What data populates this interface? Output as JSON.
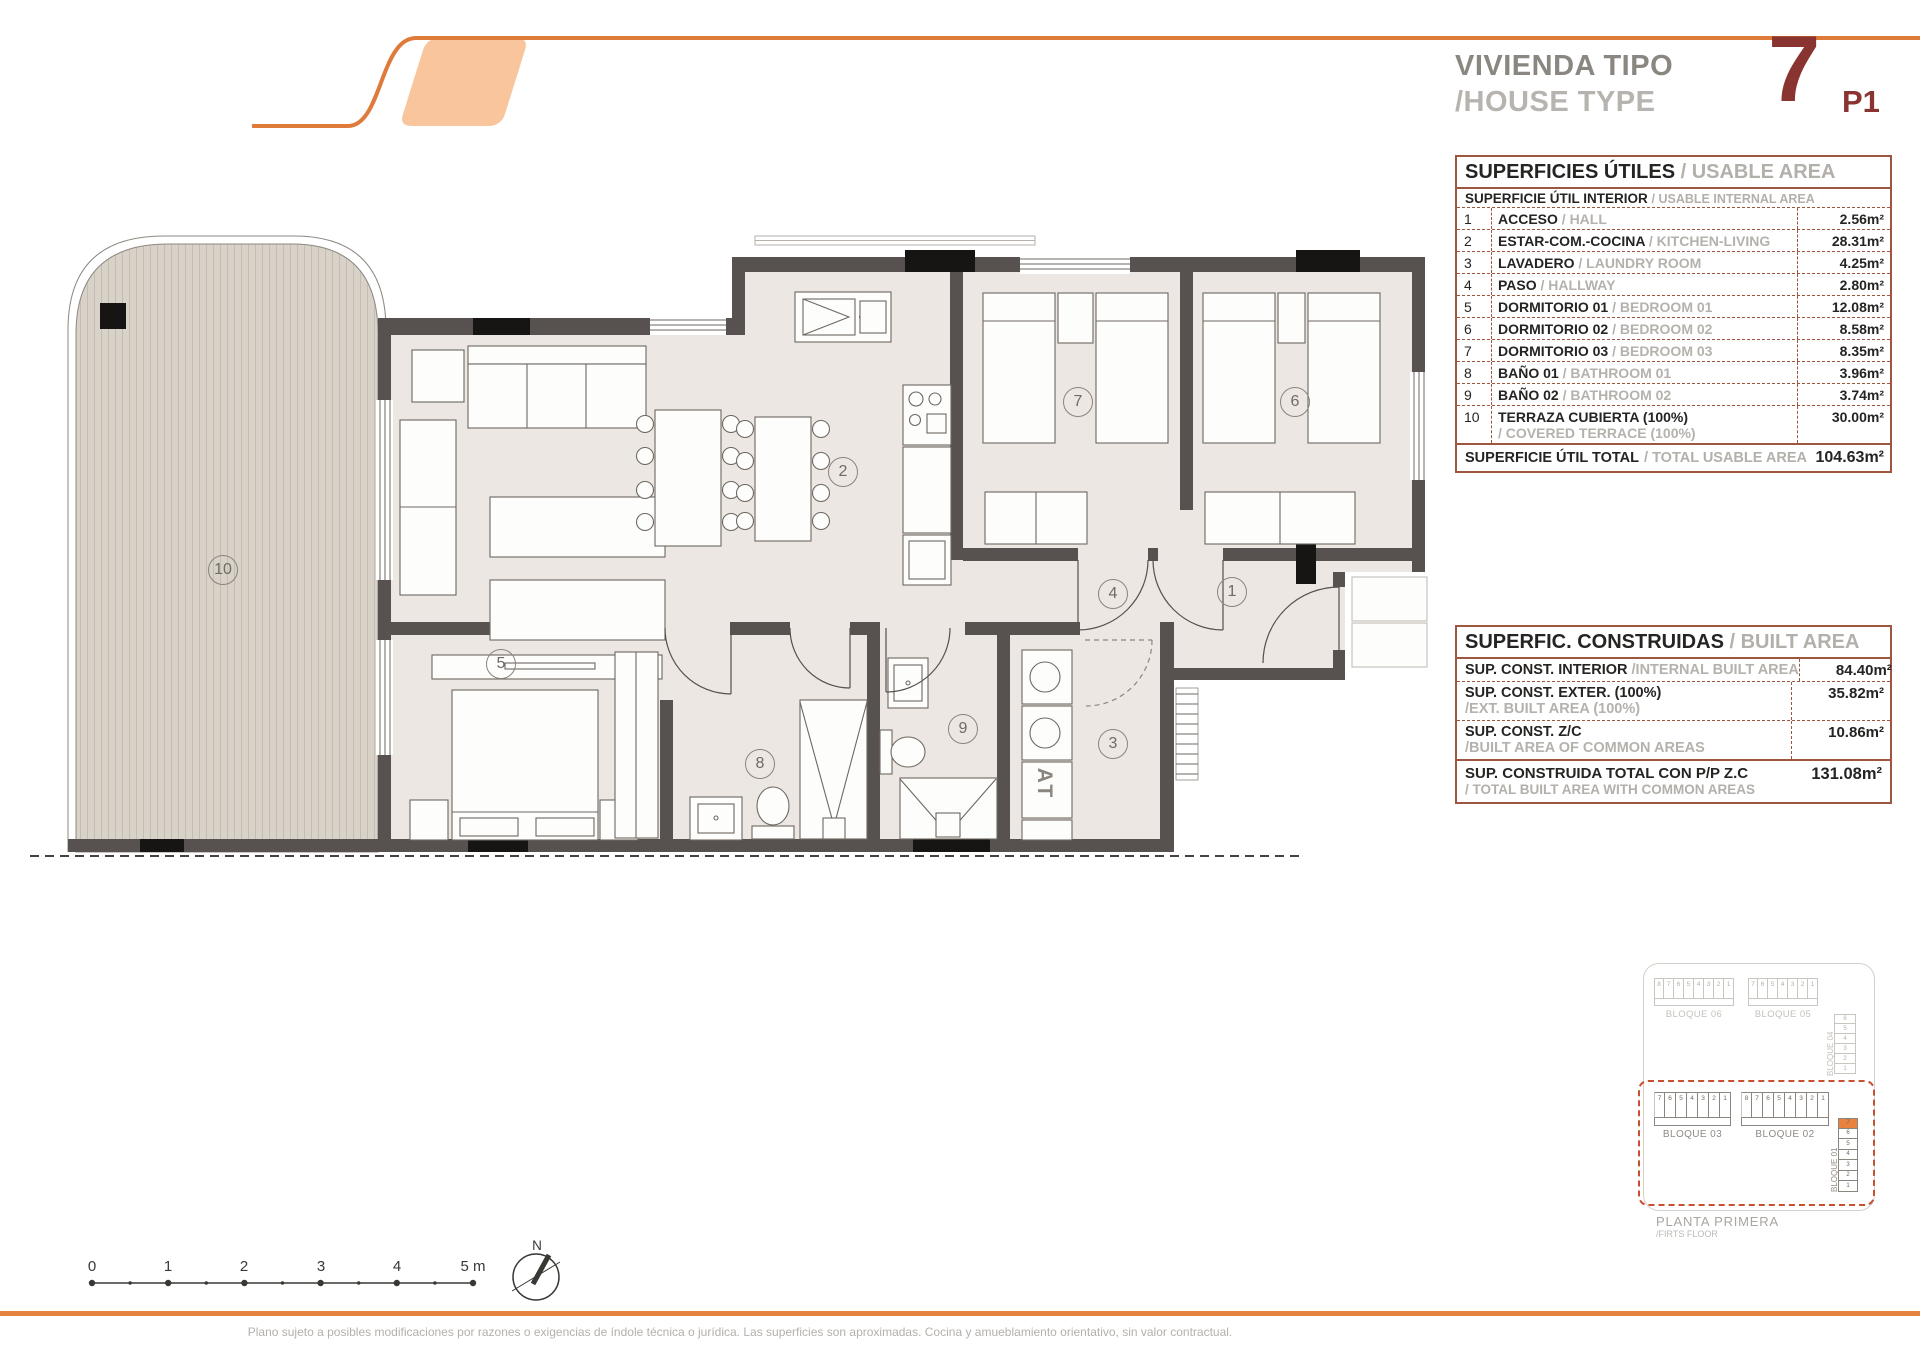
{
  "header": {
    "title_line1": "VIVIENDA TIPO",
    "title_line2": "/HOUSE TYPE",
    "type_number": "7",
    "type_code": "P1"
  },
  "usable_table": {
    "title": "SUPERFICIES ÚTILES",
    "title_en": "/ USABLE AREA",
    "subtitle": "SUPERFICIE ÚTIL INTERIOR",
    "subtitle_en": "/ USABLE INTERNAL AREA",
    "rows": [
      {
        "num": "1",
        "es": "ACCESO",
        "en": "/ HALL",
        "area": "2.56m²",
        "stacked": false
      },
      {
        "num": "2",
        "es": "ESTAR-COM.-COCINA",
        "en": "/ KITCHEN-LIVING",
        "area": "28.31m²",
        "stacked": false
      },
      {
        "num": "3",
        "es": "LAVADERO",
        "en": "/ LAUNDRY ROOM",
        "area": "4.25m²",
        "stacked": false
      },
      {
        "num": "4",
        "es": "PASO",
        "en": "/ HALLWAY",
        "area": "2.80m²",
        "stacked": false
      },
      {
        "num": "5",
        "es": "DORMITORIO 01",
        "en": "/ BEDROOM 01",
        "area": "12.08m²",
        "stacked": false
      },
      {
        "num": "6",
        "es": "DORMITORIO 02",
        "en": "/ BEDROOM 02",
        "area": "8.58m²",
        "stacked": false
      },
      {
        "num": "7",
        "es": "DORMITORIO 03",
        "en": "/ BEDROOM 03",
        "area": "8.35m²",
        "stacked": false
      },
      {
        "num": "8",
        "es": "BAÑO 01",
        "en": "/ BATHROOM 01",
        "area": "3.96m²",
        "stacked": false
      },
      {
        "num": "9",
        "es": "BAÑO 02",
        "en": "/ BATHROOM 02",
        "area": "3.74m²",
        "stacked": false
      },
      {
        "num": "10",
        "es": "TERRAZA CUBIERTA (100%)",
        "en": "/ COVERED TERRACE (100%)",
        "area": "30.00m²",
        "stacked": true
      }
    ],
    "total_es": "SUPERFICIE ÚTIL TOTAL",
    "total_en": "/ TOTAL USABLE AREA",
    "total_area": "104.63m²"
  },
  "built_table": {
    "title": "SUPERFIC. CONSTRUIDAS",
    "title_en": "/ BUILT AREA",
    "rows": [
      {
        "es": "SUP. CONST. INTERIOR",
        "en": "/INTERNAL BUILT AREA",
        "area": "84.40m²",
        "stacked": false
      },
      {
        "es": "SUP. CONST. EXTER. (100%)",
        "en": "/EXT. BUILT AREA (100%)",
        "area": "35.82m²",
        "stacked": true
      },
      {
        "es": "SUP. CONST. Z/C",
        "en": "/BUILT AREA OF COMMON AREAS",
        "area": "10.86m²",
        "stacked": true
      }
    ],
    "total_es": "SUP. CONSTRUIDA TOTAL CON P/P Z.C",
    "total_en": "/ TOTAL BUILT AREA WITH COMMON AREAS",
    "total_area": "131.08m²"
  },
  "plan": {
    "rooms": [
      "10",
      "2",
      "7",
      "6",
      "4",
      "1",
      "5",
      "8",
      "9",
      "3"
    ],
    "at_label": "AT"
  },
  "key_plan": {
    "blocks_top": [
      {
        "label": "BLOQUE 06",
        "cells": [
          "8",
          "7",
          "6",
          "5",
          "4",
          "3",
          "2",
          "1"
        ]
      },
      {
        "label": "BLOQUE 05",
        "cells": [
          "7",
          "6",
          "5",
          "4",
          "3",
          "2",
          "1"
        ]
      }
    ],
    "block_right": {
      "label": "BLOQUE 04",
      "cells": [
        "6",
        "5",
        "4",
        "3",
        "2",
        "1"
      ]
    },
    "blocks_main": [
      {
        "label": "BLOQUE 03",
        "cells": [
          "7",
          "6",
          "5",
          "4",
          "3",
          "2",
          "1"
        ]
      },
      {
        "label": "BLOQUE 02",
        "cells": [
          "8",
          "7",
          "6",
          "5",
          "4",
          "3",
          "2",
          "1"
        ]
      }
    ],
    "block_vertical": {
      "label": "BLOQUE 01",
      "cells": [
        "7",
        "6",
        "5",
        "4",
        "3",
        "2",
        "1"
      ],
      "highlight": "7"
    },
    "caption": "PLANTA PRIMERA",
    "caption_en": "/FIRTS FLOOR"
  },
  "scale_bar": {
    "labels": [
      "0",
      "1",
      "2",
      "3",
      "4",
      "5 m"
    ]
  },
  "compass": {
    "label": "N"
  },
  "footer": {
    "disclaimer": "Plano sujeto a posibles modificaciones por razones o exigencias de índole técnica o jurídica. Las superficies son aproximadas. Cocina y amueblamiento orientativo, sin valor contractual."
  },
  "colors": {
    "accent_orange": "#e5823f",
    "logo_fill": "#f8c59d",
    "maroon": "#8a3431",
    "table_border": "#9d5741",
    "wall": "#575150",
    "floor": "#ede7e4",
    "terrace": "#d8d2c9",
    "keyplan_dashed": "#c8502f"
  }
}
